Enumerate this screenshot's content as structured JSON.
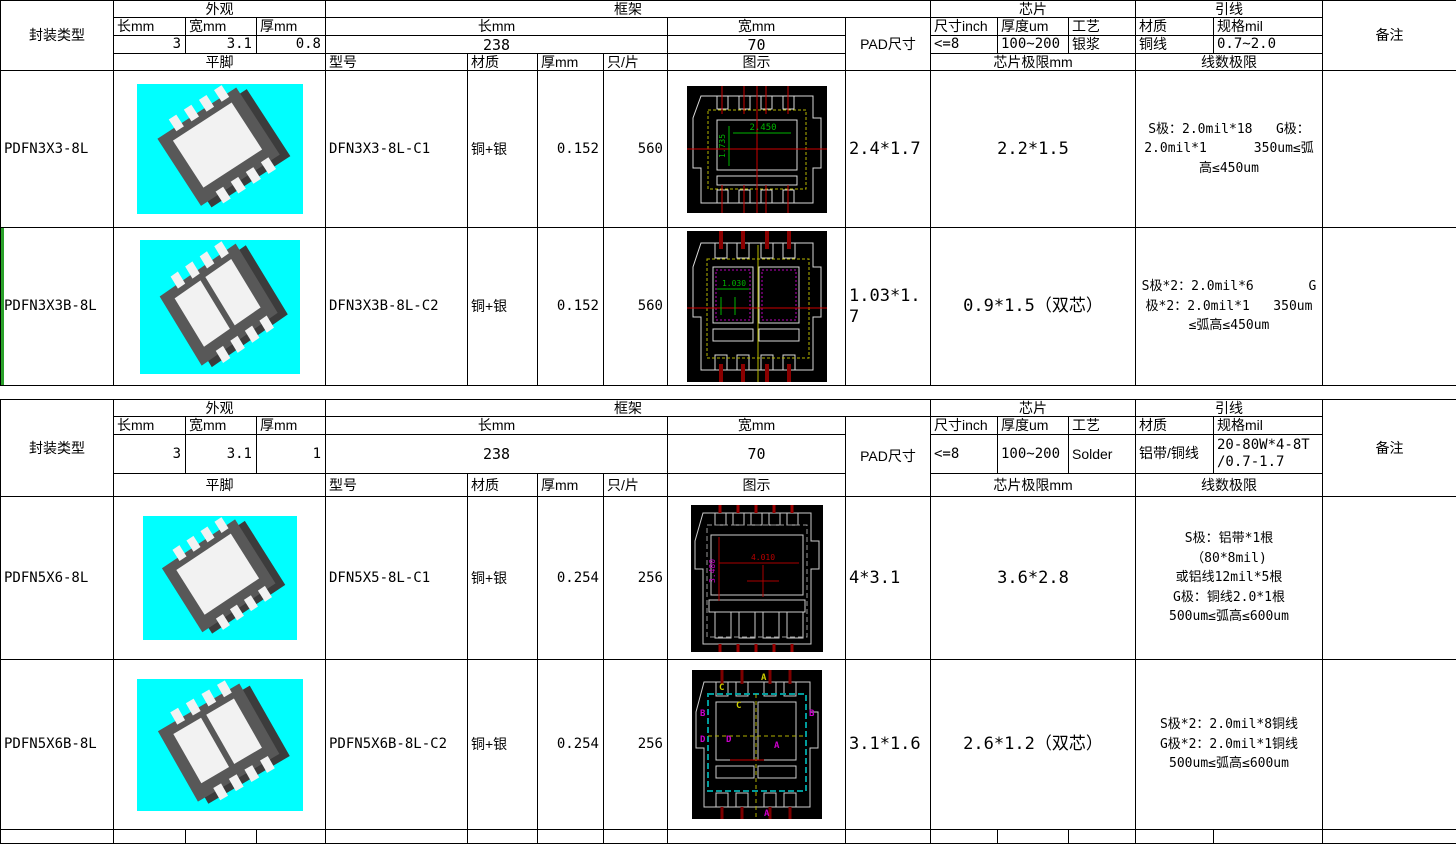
{
  "sections": [
    {
      "package_type_label": "封装类型",
      "appearance": {
        "title": "外观",
        "len_label": "长mm",
        "wid_label": "宽mm",
        "thk_label": "厚mm",
        "len": "3",
        "wid": "3.1",
        "thk": "0.8",
        "foot_label": "平脚"
      },
      "frame": {
        "title": "框架",
        "len_label": "长mm",
        "wid_label": "宽mm",
        "len": "238",
        "wid": "70",
        "model_label": "型号",
        "material_label": "材质",
        "thk_label": "厚mm",
        "pcs_label": "只/片",
        "diagram_label": "图示"
      },
      "pad_label": "PAD尺寸",
      "chip": {
        "title": "芯片",
        "size_label": "尺寸inch",
        "thickness_label": "厚度um",
        "process_label": "工艺",
        "size": "<=8",
        "thickness": "100~200",
        "process": "银浆",
        "limit_label": "芯片极限mm"
      },
      "wire": {
        "title": "引线",
        "material_label": "材质",
        "spec_label": "规格mil",
        "material": "铜线",
        "spec": "0.7~2.0",
        "limit_label": "线数极限"
      },
      "remark_label": "备注",
      "rows": [
        {
          "package_type": "PDFN3X3-8L",
          "model": "DFN3X3-8L-C1",
          "material": "铜+银",
          "thickness": "0.152",
          "pcs": "560",
          "pad_size": "2.4*1.7",
          "chip_limit": "2.2*1.5",
          "wire_limit": "S极：2.0mil*18   G极：\n2.0mil*1      350um≤弧\n高≤450um",
          "remark": "",
          "diagram": {
            "dim_h": "2.450",
            "dim_v": "1.735"
          }
        },
        {
          "package_type": "PDFN3X3B-8L",
          "model": "DFN3X3B-8L-C2",
          "material": "铜+银",
          "thickness": "0.152",
          "pcs": "560",
          "pad_size": "1.03*1.7",
          "chip_limit": "0.9*1.5（双芯）",
          "wire_limit": "S极*2：2.0mil*6       G\n极*2：2.0mil*1   350um\n≤弧高≤450um",
          "remark": "",
          "diagram": {
            "dim_h": "1.030"
          }
        }
      ]
    },
    {
      "package_type_label": "封装类型",
      "appearance": {
        "title": "外观",
        "len_label": "长mm",
        "wid_label": "宽mm",
        "thk_label": "厚mm",
        "len": "3",
        "wid": "3.1",
        "thk": "1",
        "foot_label": "平脚"
      },
      "frame": {
        "title": "框架",
        "len_label": "长mm",
        "wid_label": "宽mm",
        "len": "238",
        "wid": "70",
        "model_label": "型号",
        "material_label": "材质",
        "thk_label": "厚mm",
        "pcs_label": "只/片",
        "diagram_label": "图示"
      },
      "pad_label": "PAD尺寸",
      "chip": {
        "title": "芯片",
        "size_label": "尺寸inch",
        "thickness_label": "厚度um",
        "process_label": "工艺",
        "size": "<=8",
        "thickness": "100~200",
        "process": "Solder",
        "limit_label": "芯片极限mm"
      },
      "wire": {
        "title": "引线",
        "material_label": "材质",
        "spec_label": "规格mil",
        "material": "铝带/铜线",
        "spec": "20-80W*4-8T\n/0.7-1.7",
        "limit_label": "线数极限"
      },
      "remark_label": "备注",
      "rows": [
        {
          "package_type": "PDFN5X6-8L",
          "model": "DFN5X5-8L-C1",
          "material": "铜+银",
          "thickness": "0.254",
          "pcs": "256",
          "pad_size": "4*3.1",
          "chip_limit": "3.6*2.8",
          "wire_limit": "S极：铝带*1根\n（80*8mil)\n或铝线12mil*5根\nG极：铜线2.0*1根\n500um≤弧高≤600um",
          "remark": "",
          "diagram": {
            "dim_h": "4.010",
            "dim_v": "3.480"
          }
        },
        {
          "package_type": "PDFN5X6B-8L",
          "model": "PDFN5X6B-8L-C2",
          "material": "铜+银",
          "thickness": "0.254",
          "pcs": "256",
          "pad_size": "3.1*1.6",
          "chip_limit": "2.6*1.2（双芯）",
          "wire_limit": "S极*2：2.0mil*8铜线\nG极*2：2.0mil*1铜线\n500um≤弧高≤600um",
          "remark": "",
          "diagram": {
            "letter_a": "A",
            "letter_b": "B",
            "letter_c": "C",
            "letter_d": "D"
          }
        }
      ]
    }
  ]
}
